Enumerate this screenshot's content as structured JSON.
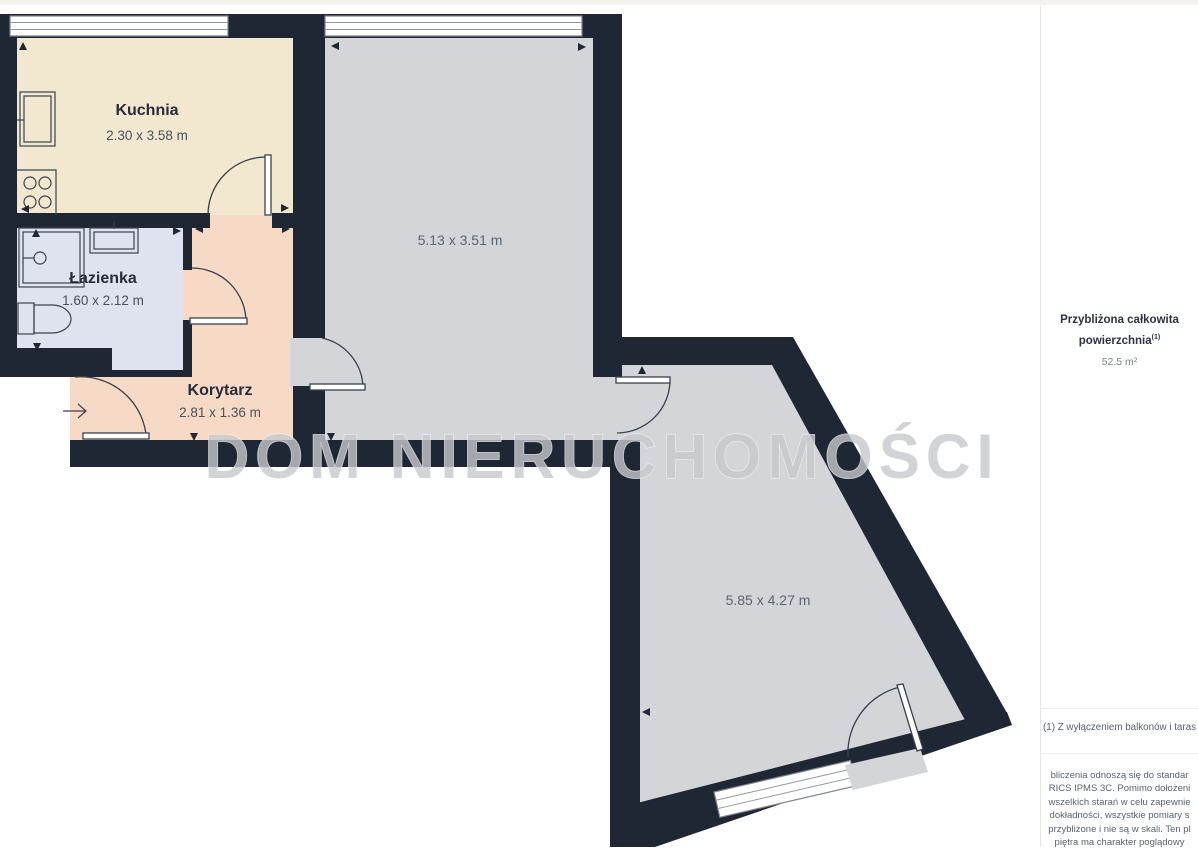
{
  "plan": {
    "watermark": "DOM NIERUCHOMOŚCI",
    "rooms": {
      "kuchnia": {
        "name": "Kuchnia",
        "dims": "2.30 x 3.58 m"
      },
      "lazienka": {
        "name": "Łazienka",
        "dims": "1.60 x 2.12 m"
      },
      "korytarz": {
        "name": "Korytarz",
        "dims": "2.81 x 1.36 m"
      },
      "room_top": {
        "dims": "5.13 x 3.51 m"
      },
      "room_bottom": {
        "dims": "5.85 x 4.27 m"
      }
    },
    "colors": {
      "wall": "#1f2734",
      "kitchen_floor": "#f1e8cf",
      "bathroom_floor": "#dfe3ef",
      "corridor_floor": "#f7dac6",
      "room_floor_gray": "#d4d5d8",
      "watermark_gray": "#c6c8cc"
    }
  },
  "panel": {
    "title_line1": "Przybliżona całkowita",
    "title_line2": "powierzchnia",
    "title_sup": "(1)",
    "area_value": "52.5 m²",
    "footnote": "(1) Z wyłączeniem balkonów i taras",
    "disclaimer_lines": [
      "bliczenia odnoszą się do standar",
      "RICS IPMS 3C. Pomimo dołożeni",
      "wszelkich starań w celu zapewnie",
      "dokładności, wszystkie pomiary s",
      "przybliżone i nie są w skali. Ten pl",
      "piętra ma charakter poglądowy"
    ]
  }
}
